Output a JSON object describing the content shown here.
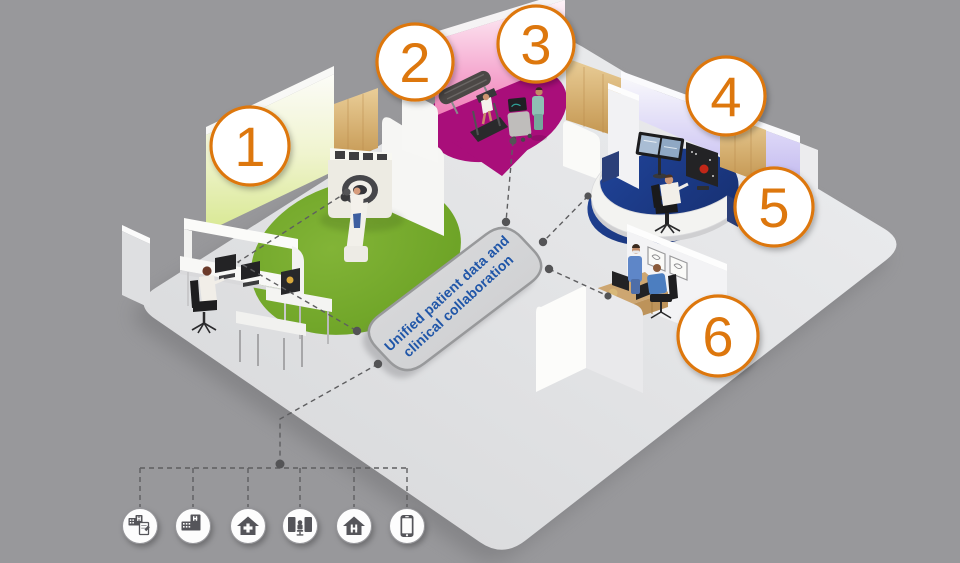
{
  "hub": {
    "line1": "Unified patient data and",
    "line2": "clinical collaboration",
    "text_color": "#2056A8"
  },
  "callouts": [
    {
      "label": "1"
    },
    {
      "label": "2"
    },
    {
      "label": "3"
    },
    {
      "label": "4"
    },
    {
      "label": "5"
    },
    {
      "label": "6"
    }
  ],
  "care_icons": [
    {
      "name": "hospital-report-icon"
    },
    {
      "name": "hospital-building-icon"
    },
    {
      "name": "health-center-icon"
    },
    {
      "name": "reading-room-workstation-icon"
    },
    {
      "name": "hospital-at-home-icon"
    },
    {
      "name": "mobile-phone-icon"
    }
  ],
  "colors": {
    "background": "#98989B",
    "floor": "#E2E3E5",
    "accent_orange": "#DD770E",
    "zone_green": "#74A82B",
    "zone_magenta": "#A90E7A",
    "zone_blue": "#1B3A8C",
    "glow_green": "#D8E892",
    "glow_pink": "#F07FB7",
    "glow_lavender": "#BFB6EE",
    "wood": "#D3A964",
    "connector_gray": "#5E5E60",
    "hub_fill": "#D5D6D8"
  }
}
